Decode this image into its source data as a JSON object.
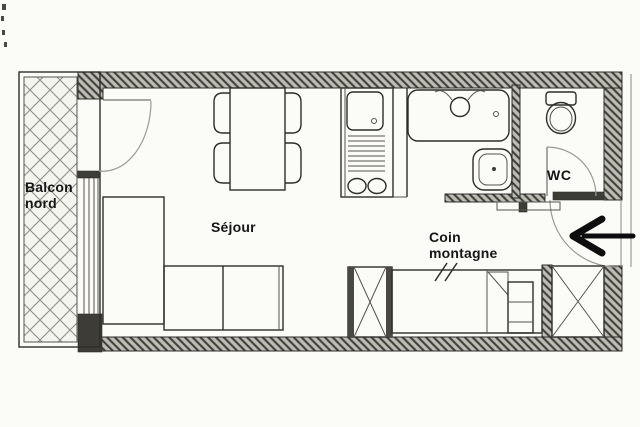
{
  "rooms": {
    "balcony": {
      "line1": "Balcon",
      "line2": "nord"
    },
    "living": {
      "label": "Séjour"
    },
    "nook": {
      "line1": "Coin",
      "line2": "montagne"
    },
    "wc": {
      "label": "WC"
    }
  },
  "icons": {
    "entrance_arrow": "left-arrow"
  },
  "colors": {
    "background": "#fbfbf8",
    "line": "#2d2d29",
    "wall_hatch_bg": "#bdbdb5",
    "wall_hatch_line": "#403f39",
    "wall_dark": "#3e3c37",
    "arrow": "#0d0d0d",
    "text": "#161616"
  }
}
